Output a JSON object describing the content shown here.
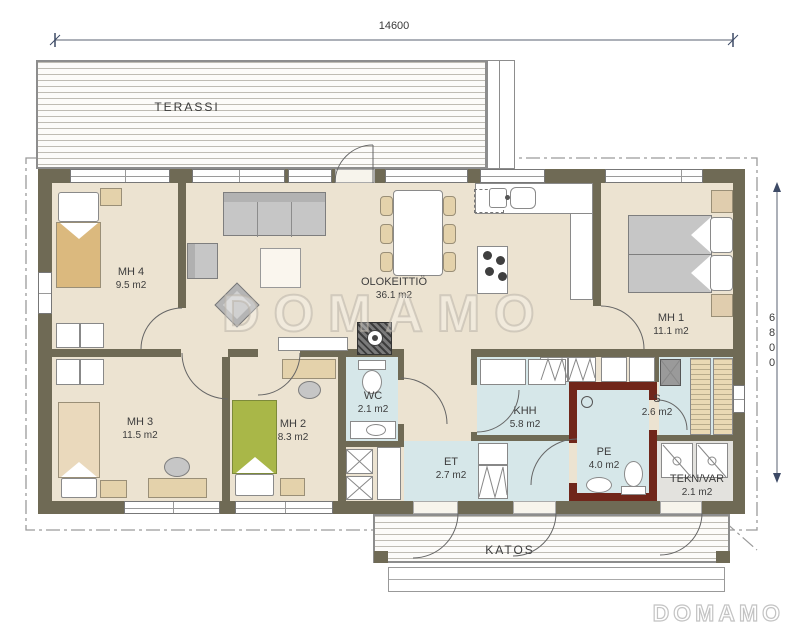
{
  "plan_title": "house floor plan",
  "dimensions": {
    "width": "14600",
    "height": "6800"
  },
  "outdoor": {
    "terrace": "TERASSI",
    "canopy": "KATOS"
  },
  "rooms": [
    {
      "name": "MH 4",
      "area": "9.5 m2"
    },
    {
      "name": "MH 3",
      "area": "11.5 m2"
    },
    {
      "name": "MH 2",
      "area": "8.3 m2"
    },
    {
      "name": "OLOKEITTIÖ",
      "area": "36.1 m2"
    },
    {
      "name": "MH 1",
      "area": "11.1 m2"
    },
    {
      "name": "WC",
      "area": "2.1 m2"
    },
    {
      "name": "KHH",
      "area": "5.8 m2"
    },
    {
      "name": "ET",
      "area": "2.7 m2"
    },
    {
      "name": "PE",
      "area": "4.0 m2"
    },
    {
      "name": "S",
      "area": "2.6 m2"
    },
    {
      "name": "TEKN/VAR",
      "area": "2.1 m2"
    }
  ],
  "watermark": "DOMAMO",
  "logo": "DOMAMO",
  "colors": {
    "wall": "#6f6a55",
    "wet_room_wall": "#70261a",
    "floor": "#ece3d1",
    "wet_floor": "#d6e7e9",
    "dimension_accent": "#3d4a66"
  }
}
